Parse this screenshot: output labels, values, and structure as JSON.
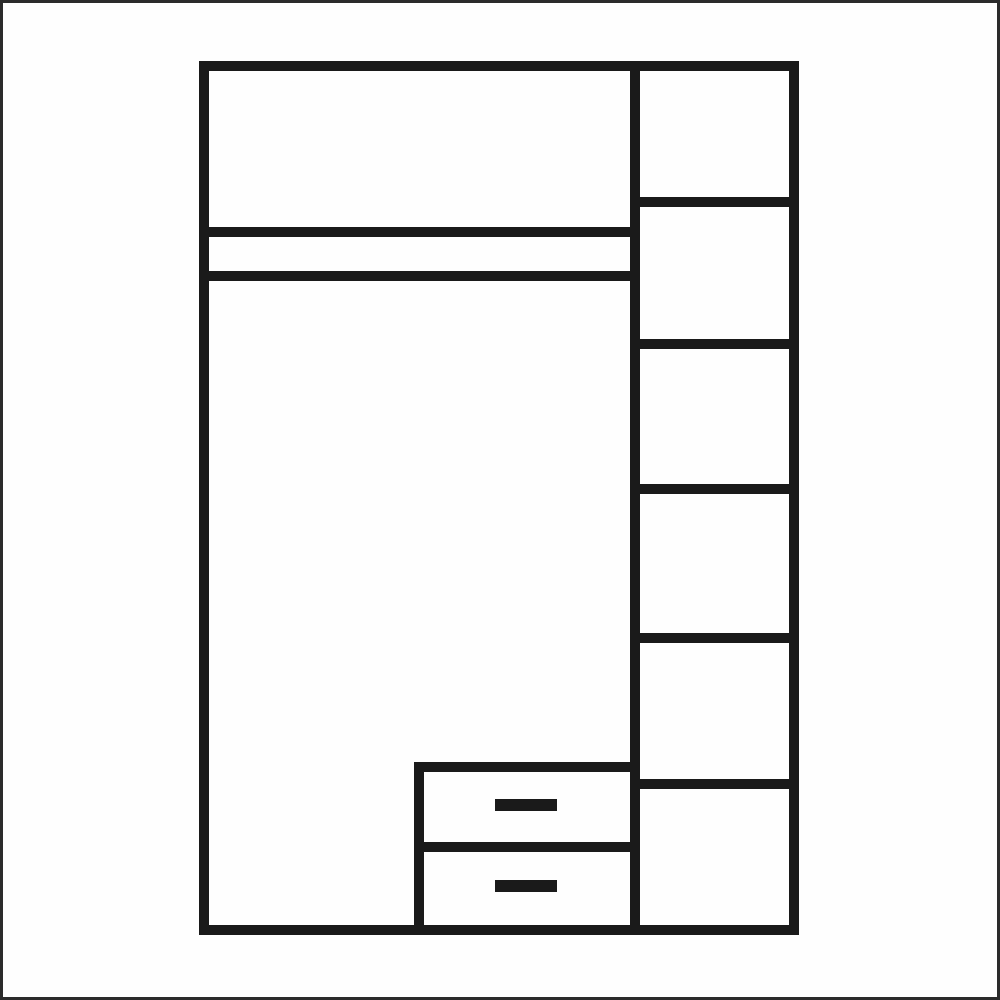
{
  "page": {
    "width": 1000,
    "height": 1000,
    "background_color": "#fefefe",
    "outer_border": {
      "color": "#2b2b2b",
      "width": 3
    }
  },
  "diagram": {
    "type": "furniture-front-view",
    "subject": "wardrobe interior layout with left hanging section, top double shelf band, two bottom drawers and a right column of six shelf compartments",
    "stroke": {
      "color": "#1a1a1a",
      "width": 10
    },
    "frame": {
      "name": "wardrobe-frame",
      "x": 204,
      "y": 66,
      "width": 590,
      "height": 864
    },
    "lines": [
      {
        "name": "center-vertical-divider",
        "x1": 635,
        "y1": 61,
        "x2": 635,
        "y2": 935
      },
      {
        "name": "left-upper-shelf-line",
        "x1": 201,
        "y1": 232,
        "x2": 640,
        "y2": 232
      },
      {
        "name": "left-lower-shelf-line",
        "x1": 201,
        "y1": 276,
        "x2": 640,
        "y2": 276
      },
      {
        "name": "right-shelf-line-1",
        "x1": 630,
        "y1": 202,
        "x2": 797,
        "y2": 202
      },
      {
        "name": "right-shelf-line-2",
        "x1": 630,
        "y1": 344,
        "x2": 797,
        "y2": 344
      },
      {
        "name": "right-shelf-line-3",
        "x1": 630,
        "y1": 489,
        "x2": 797,
        "y2": 489
      },
      {
        "name": "right-shelf-line-4",
        "x1": 630,
        "y1": 638,
        "x2": 797,
        "y2": 638
      },
      {
        "name": "right-shelf-line-5",
        "x1": 630,
        "y1": 784,
        "x2": 797,
        "y2": 784
      },
      {
        "name": "drawer-unit-top-line",
        "x1": 414,
        "y1": 767,
        "x2": 640,
        "y2": 767
      },
      {
        "name": "drawer-unit-left-line",
        "x1": 419,
        "y1": 762,
        "x2": 419,
        "y2": 933
      },
      {
        "name": "drawer-divider-line",
        "x1": 414,
        "y1": 847,
        "x2": 640,
        "y2": 847
      }
    ],
    "filled_rects": [
      {
        "name": "drawer-handle-top",
        "x": 495,
        "y": 799,
        "width": 62,
        "height": 12
      },
      {
        "name": "drawer-handle-bottom",
        "x": 495,
        "y": 880,
        "width": 62,
        "height": 12
      }
    ],
    "semantics": {
      "left_section": {
        "top_compartment_count": 1,
        "shelf_band_lines": 2,
        "hanging_area": true,
        "drawer_count": 2,
        "drawer_handle_count": 2
      },
      "right_column": {
        "shelf_compartment_count": 6,
        "shelf_line_count": 5
      }
    }
  }
}
